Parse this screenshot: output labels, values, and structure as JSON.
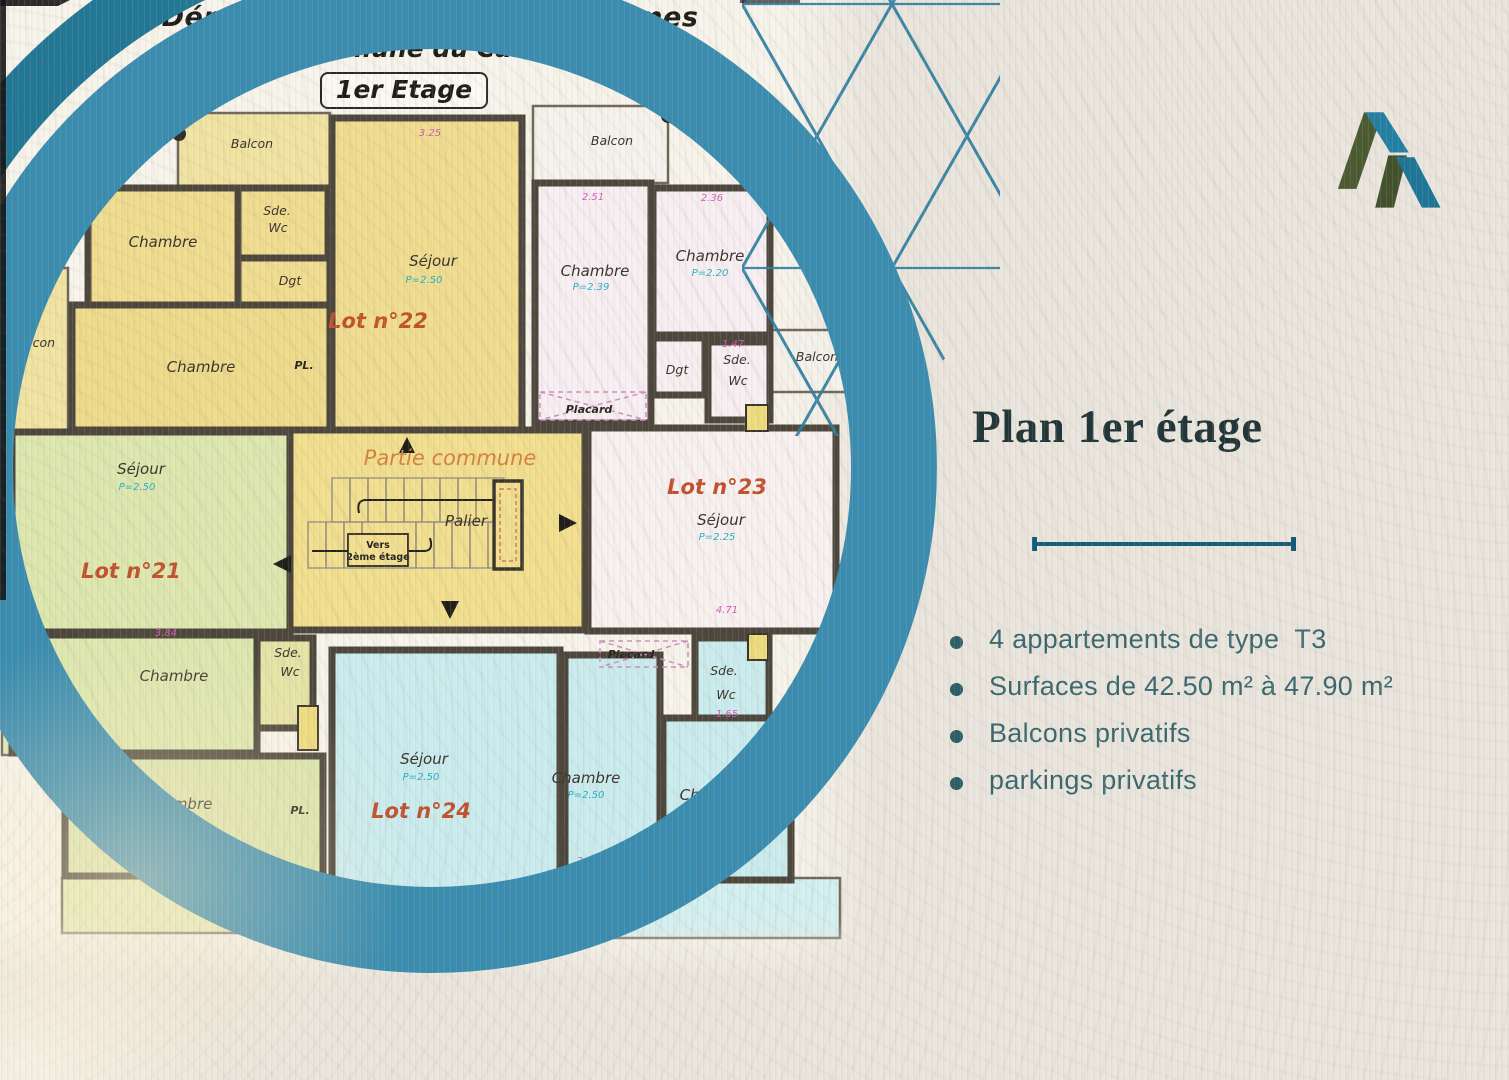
{
  "header": {
    "line1": "Département des Alpes-Maritimes",
    "line2": "Commune du Cannet",
    "floor_badge": "1er Etage"
  },
  "panel": {
    "title": "Plan 1er étage",
    "bullets": [
      "4 appartements de type  T3",
      "Surfaces de 42.50 m² à 47.90 m²",
      "Balcons privatifs",
      "parkings privatifs"
    ]
  },
  "plan": {
    "lots": {
      "lot21": "Lot n°21",
      "lot22": "Lot n°22",
      "lot23": "Lot n°23",
      "lot24": "Lot n°24"
    },
    "rooms": {
      "sejour": "Séjour",
      "chambre": "Chambre",
      "balcon": "Balcon",
      "sde": "Sde.",
      "wc": "Wc",
      "dgt": "Dgt",
      "placard": "Placard",
      "pl": "PL.",
      "palier": "Palier",
      "partie_commune": "Partie commune",
      "vers": "Vers",
      "deuxieme_etage": "2ème étage"
    },
    "dimensions": {
      "d1": "2.51",
      "d2": "2.36",
      "d3": "1.47",
      "d4": "1.65",
      "d5": "4.71",
      "d6": "2.50",
      "d7": "3.84",
      "d8": "3.04",
      "d9": "3.25"
    },
    "heights": {
      "h1": "P=2.50",
      "h2": "P=2.39",
      "h3": "P=2.20",
      "h4": "P=2.25"
    }
  },
  "colors": {
    "ring_teal": "#3a8db0",
    "corner_arc_teal": "#217795",
    "lattice_teal": "#2d7e9f",
    "divider_teal": "#155c78",
    "title_dark": "#213538",
    "bullet_text": "#39686f",
    "lot_label_orange": "#c2512c",
    "wall_dark": "#4c463c",
    "logo_green": "#4a5a31",
    "logo_teal": "#2380a4"
  }
}
